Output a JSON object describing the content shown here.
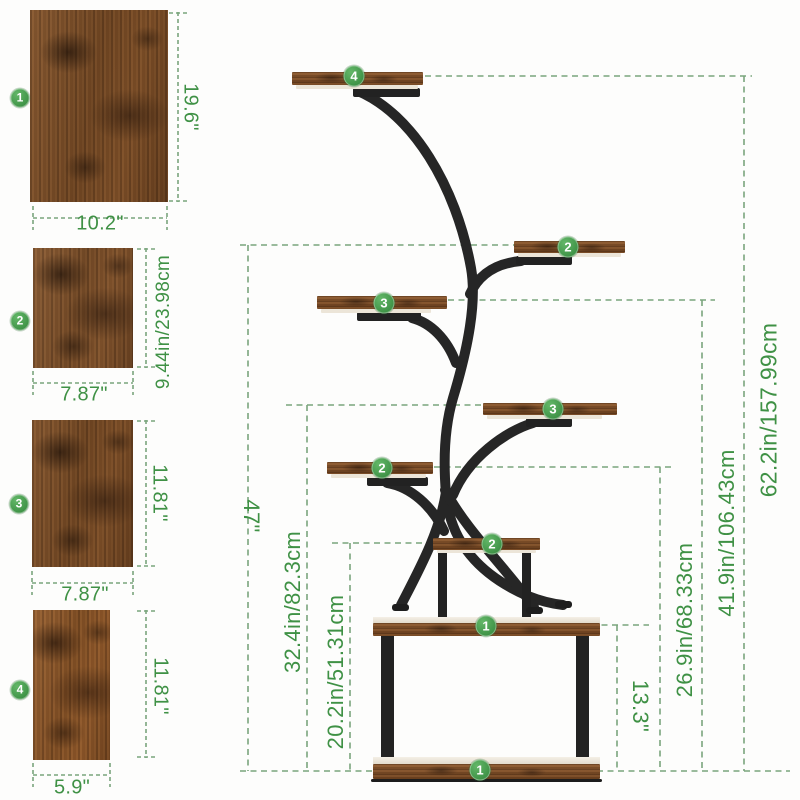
{
  "panels": [
    {
      "num": "1",
      "width_label": "10.2\"",
      "height_label": "19.6\""
    },
    {
      "num": "2",
      "width_label": "7.87\"",
      "height_label": "9.44in/23.98cm"
    },
    {
      "num": "3",
      "width_label": "7.87\"",
      "height_label": "11.81\""
    },
    {
      "num": "4",
      "width_label": "5.9\"",
      "height_label": "11.81\""
    }
  ],
  "stand": {
    "badges": [
      {
        "label": "4"
      },
      {
        "label": "2"
      },
      {
        "label": "3"
      },
      {
        "label": "3"
      },
      {
        "label": "2"
      },
      {
        "label": "2"
      },
      {
        "label": "1"
      },
      {
        "label": "1"
      }
    ],
    "dimensions": {
      "h47": "47\"",
      "h32": "32.4in/82.3cm",
      "h20": "20.2in/51.31cm",
      "h13": "13.3\"",
      "h26": "26.9in/68.33cm",
      "h41": "41.9in/106.43cm",
      "total": "62.2in/157.99cm"
    }
  },
  "colors": {
    "accent_green": "#3f9145",
    "dash_green": "#7aa57c",
    "tube_black": "#262626",
    "wood_brown": "#7a4c26"
  }
}
